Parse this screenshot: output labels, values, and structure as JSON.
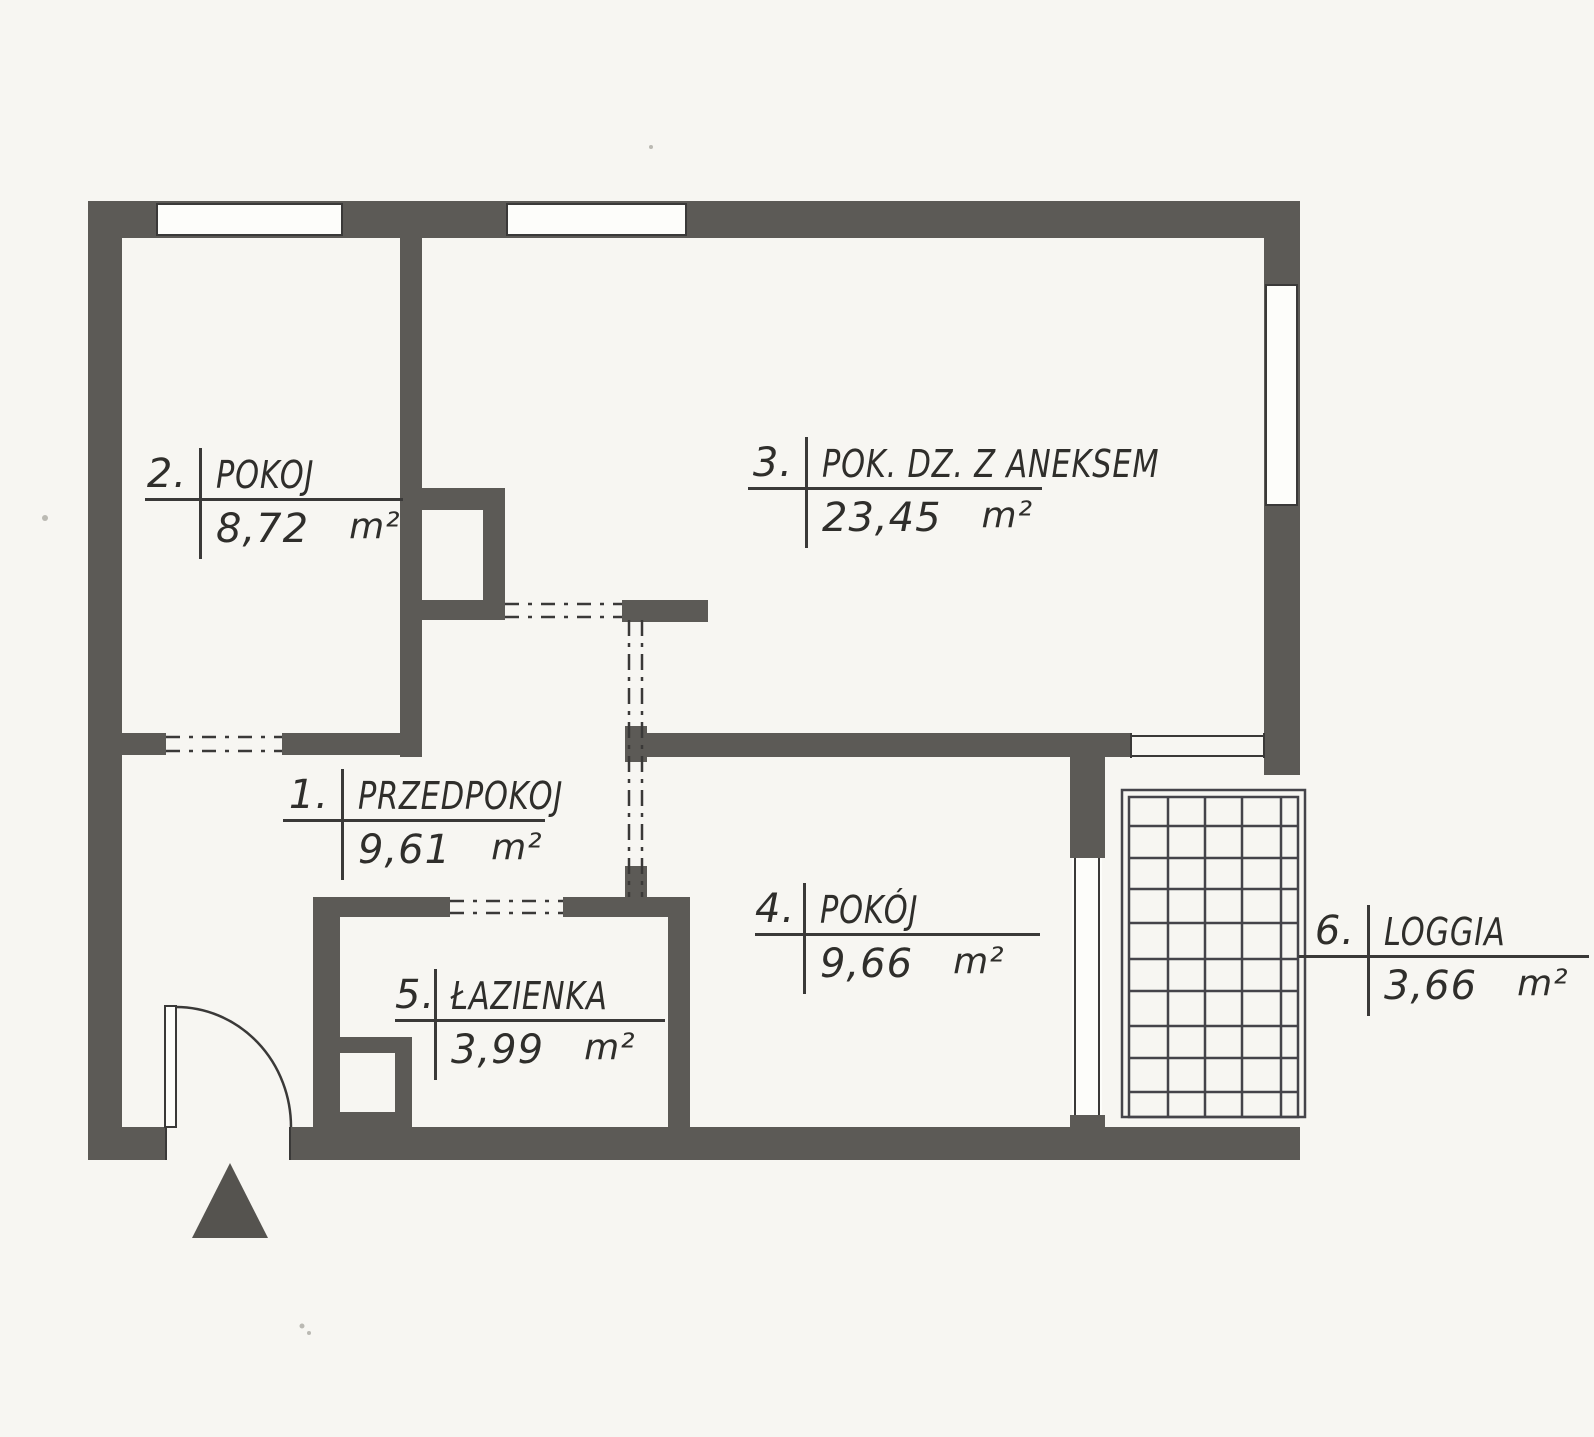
{
  "rooms": [
    {
      "number": "1.",
      "name": "PRZEDPOKOJ",
      "area": "9,61",
      "unit": "m²"
    },
    {
      "number": "2.",
      "name": "POKOJ",
      "area": "8,72",
      "unit": "m²"
    },
    {
      "number": "3.",
      "name": "POK. DZ. Z ANEKSEM",
      "area": "23,45",
      "unit": "m²"
    },
    {
      "number": "4.",
      "name": "POKÓJ",
      "area": "9,66",
      "unit": "m²"
    },
    {
      "number": "5.",
      "name": "ŁAZIENKA",
      "area": "3,99",
      "unit": "m²"
    },
    {
      "number": "6.",
      "name": "LOGGIA",
      "area": "3,66",
      "unit": "m²"
    }
  ],
  "colors": {
    "wall": "#5c5a56",
    "line": "#3a3938",
    "paper": "#f7f6f2",
    "text": "#2f2e2b"
  },
  "symbols": {
    "entrance_marker": "filled-triangle-arrow",
    "entrance_door": "quarter-circle-door-swing",
    "loggia_floor": "tile-grid",
    "openings": "dash-dot-lines",
    "windows": "white-gaps-in-walls"
  }
}
